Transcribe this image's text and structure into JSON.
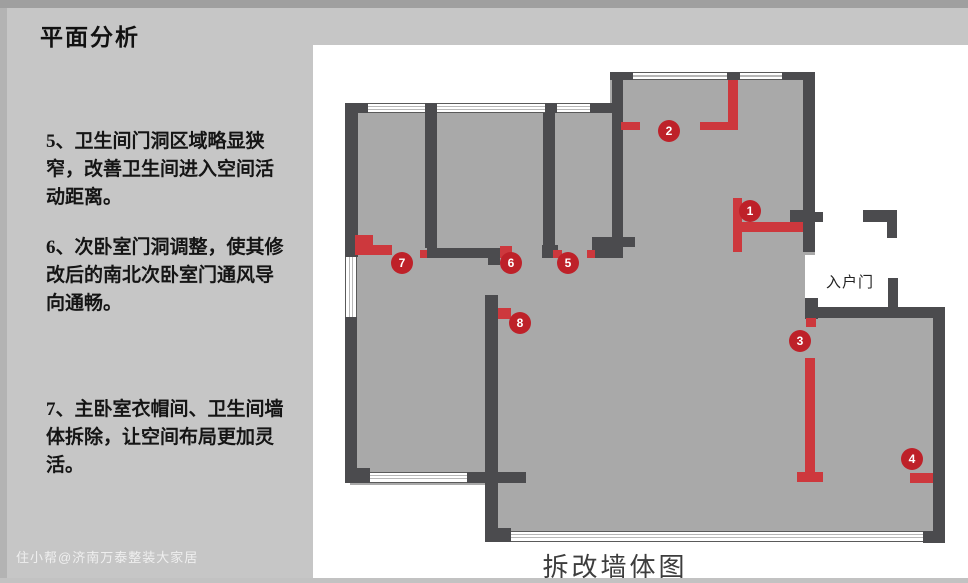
{
  "title": "平面分析",
  "notes": [
    {
      "text": "5、卫生间门洞区域略显狭\n窄，改善卫生间进入空间活\n动距离。"
    },
    {
      "text": "6、次卧室门洞调整，使其修\n改后的南北次卧室门通风导\n向通畅。"
    },
    {
      "text": "7、主卧室衣帽间、卫生间墙\n体拆除，让空间布局更加灵\n活。"
    }
  ],
  "watermark": "住小帮@济南万泰整装大家居",
  "diagram": {
    "caption": "拆改墙体图",
    "entrance_label": "入户门",
    "colors": {
      "slide_bg": "#c6c6c6",
      "panel": "#ffffff",
      "floor": "#a9a9a9",
      "wall": "#4b4b4e",
      "demolish_red": "#cd383d",
      "marker_red": "#be2129"
    },
    "floors": [
      [
        350,
        103,
        265,
        150
      ],
      [
        610,
        75,
        205,
        180
      ],
      [
        350,
        250,
        455,
        235
      ],
      [
        485,
        480,
        330,
        58
      ],
      [
        803,
        318,
        135,
        222
      ]
    ],
    "walls": [
      [
        345,
        103,
        23,
        10
      ],
      [
        425,
        103,
        12,
        10
      ],
      [
        545,
        103,
        12,
        10
      ],
      [
        590,
        103,
        23,
        10
      ],
      [
        345,
        113,
        13,
        144
      ],
      [
        345,
        317,
        12,
        151
      ],
      [
        345,
        468,
        25,
        15
      ],
      [
        425,
        113,
        12,
        135
      ],
      [
        543,
        113,
        12,
        132
      ],
      [
        542,
        245,
        16,
        13
      ],
      [
        427,
        248,
        73,
        10
      ],
      [
        488,
        256,
        12,
        9
      ],
      [
        592,
        237,
        31,
        21
      ],
      [
        623,
        237,
        12,
        10
      ],
      [
        610,
        72,
        23,
        8
      ],
      [
        727,
        72,
        13,
        8
      ],
      [
        782,
        72,
        33,
        8
      ],
      [
        612,
        80,
        11,
        157
      ],
      [
        803,
        72,
        12,
        180
      ],
      [
        790,
        210,
        13,
        12
      ],
      [
        815,
        212,
        8,
        10
      ],
      [
        863,
        210,
        34,
        12
      ],
      [
        887,
        222,
        10,
        16
      ],
      [
        888,
        278,
        10,
        30
      ],
      [
        805,
        298,
        13,
        21
      ],
      [
        805,
        307,
        138,
        11
      ],
      [
        933,
        307,
        12,
        236
      ],
      [
        923,
        531,
        22,
        12
      ],
      [
        485,
        295,
        13,
        240
      ],
      [
        485,
        528,
        26,
        14
      ],
      [
        467,
        472,
        18,
        11
      ],
      [
        498,
        472,
        28,
        11
      ]
    ],
    "windows": [
      {
        "x": 368,
        "y": 103,
        "w": 57,
        "h": 10,
        "o": "h"
      },
      {
        "x": 437,
        "y": 103,
        "w": 108,
        "h": 10,
        "o": "h"
      },
      {
        "x": 557,
        "y": 103,
        "w": 33,
        "h": 10,
        "o": "h"
      },
      {
        "x": 633,
        "y": 72,
        "w": 94,
        "h": 8,
        "o": "h"
      },
      {
        "x": 740,
        "y": 72,
        "w": 42,
        "h": 8,
        "o": "h"
      },
      {
        "x": 345,
        "y": 257,
        "w": 12,
        "h": 60,
        "o": "v"
      },
      {
        "x": 370,
        "y": 472,
        "w": 97,
        "h": 11,
        "o": "h"
      },
      {
        "x": 511,
        "y": 531,
        "w": 412,
        "h": 11,
        "o": "h"
      }
    ],
    "red_segments": [
      [
        355,
        235,
        18,
        20
      ],
      [
        373,
        245,
        19,
        10
      ],
      [
        420,
        250,
        7,
        8
      ],
      [
        500,
        246,
        12,
        12
      ],
      [
        553,
        250,
        9,
        8
      ],
      [
        587,
        250,
        8,
        8
      ],
      [
        621,
        122,
        19,
        8
      ],
      [
        728,
        80,
        10,
        50
      ],
      [
        700,
        122,
        38,
        8
      ],
      [
        733,
        198,
        9,
        54
      ],
      [
        733,
        222,
        70,
        10
      ],
      [
        806,
        318,
        10,
        9
      ],
      [
        805,
        358,
        10,
        114
      ],
      [
        797,
        472,
        26,
        10
      ],
      [
        910,
        473,
        23,
        10
      ],
      [
        498,
        308,
        13,
        11
      ]
    ],
    "markers": [
      {
        "n": "1",
        "x": 750,
        "y": 211
      },
      {
        "n": "2",
        "x": 669,
        "y": 131
      },
      {
        "n": "3",
        "x": 800,
        "y": 341
      },
      {
        "n": "4",
        "x": 912,
        "y": 459
      },
      {
        "n": "5",
        "x": 568,
        "y": 263
      },
      {
        "n": "6",
        "x": 511,
        "y": 263
      },
      {
        "n": "7",
        "x": 402,
        "y": 263
      },
      {
        "n": "8",
        "x": 520,
        "y": 323
      }
    ]
  }
}
